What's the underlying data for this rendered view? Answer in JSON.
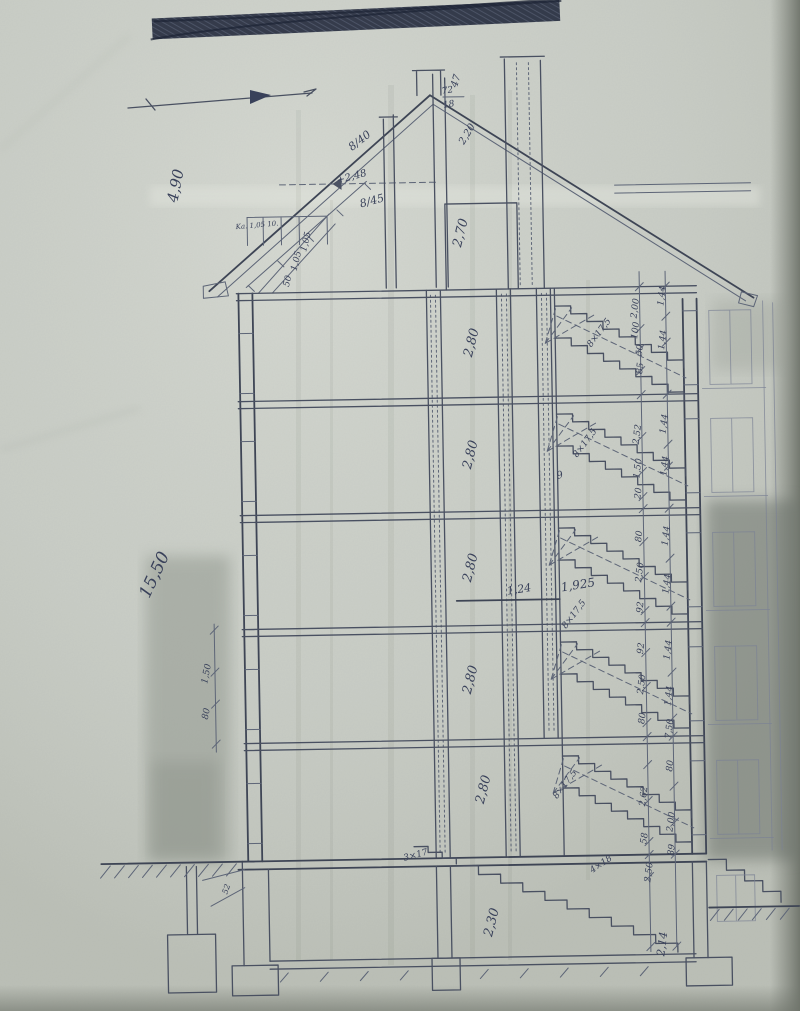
{
  "document": {
    "type": "scanned hand-drawn architectural cross-section (old blueprint photocopy)",
    "redaction_note": "hand-scribbled blacked-out line at top of sheet"
  },
  "annotations": [
    {
      "t": "4,90",
      "x": 186,
      "y": 182,
      "r": -78,
      "s": 15,
      "n": "roof-height-label"
    },
    {
      "t": "47",
      "x": 466,
      "y": 82,
      "r": -72,
      "s": 10,
      "n": "dimension-label"
    },
    {
      "t": "72",
      "x": 455,
      "y": 93,
      "r": -8,
      "s": 9,
      "n": "chimney-size-numerator"
    },
    {
      "t": "18",
      "x": 456,
      "y": 107,
      "r": -8,
      "s": 9,
      "n": "chimney-size-denominator"
    },
    {
      "t": "2,20",
      "x": 476,
      "y": 136,
      "r": -58,
      "s": 10,
      "n": "dimension-label"
    },
    {
      "t": "8/40",
      "x": 368,
      "y": 142,
      "r": -37,
      "s": 11,
      "n": "rafter-size-label"
    },
    {
      "t": "+2,48",
      "x": 358,
      "y": 178,
      "r": -14,
      "s": 10,
      "n": "level-label"
    },
    {
      "t": "8/45",
      "x": 378,
      "y": 203,
      "r": -14,
      "s": 11,
      "n": "rafter-size-label"
    },
    {
      "t": "Ka. 1,05 10.",
      "x": 262,
      "y": 224,
      "r": -4,
      "s": 7,
      "n": "attic-note-label"
    },
    {
      "t": "50",
      "x": 294,
      "y": 279,
      "r": -75,
      "s": 9,
      "n": "dimension-label"
    },
    {
      "t": "1,05",
      "x": 303,
      "y": 259,
      "r": -75,
      "s": 9,
      "n": "dimension-label"
    },
    {
      "t": "1,05",
      "x": 313,
      "y": 240,
      "r": -75,
      "s": 9,
      "n": "dimension-label"
    },
    {
      "t": "2,70",
      "x": 469,
      "y": 234,
      "r": -75,
      "s": 13,
      "n": "room-height-label"
    },
    {
      "t": "2,80",
      "x": 478,
      "y": 344,
      "r": -75,
      "s": 13,
      "n": "room-height-label"
    },
    {
      "t": "2,80",
      "x": 475,
      "y": 456,
      "r": -75,
      "s": 13,
      "n": "room-height-label"
    },
    {
      "t": "2,80",
      "x": 473,
      "y": 569,
      "r": -75,
      "s": 13,
      "n": "room-height-label"
    },
    {
      "t": "2,80",
      "x": 471,
      "y": 681,
      "r": -75,
      "s": 13,
      "n": "room-height-label"
    },
    {
      "t": "2,80",
      "x": 482,
      "y": 791,
      "r": -75,
      "s": 13,
      "n": "room-height-label"
    },
    {
      "t": "2,30",
      "x": 488,
      "y": 924,
      "r": -75,
      "s": 13,
      "n": "room-height-label"
    },
    {
      "t": "15,50",
      "x": 158,
      "y": 572,
      "r": -64,
      "s": 17,
      "n": "overall-height-label"
    },
    {
      "t": "1,50",
      "x": 206,
      "y": 670,
      "r": -78,
      "s": 9,
      "n": "dimension-label"
    },
    {
      "t": "80",
      "x": 205,
      "y": 710,
      "r": -78,
      "s": 9,
      "n": "dimension-label"
    },
    {
      "t": "1,24",
      "x": 518,
      "y": 594,
      "r": -8,
      "s": 11,
      "n": "landing-width-label"
    },
    {
      "t": "1,925",
      "x": 577,
      "y": 591,
      "r": -8,
      "s": 12,
      "n": "landing-width-label"
    },
    {
      "t": "8×17,5",
      "x": 604,
      "y": 337,
      "r": -52,
      "s": 9,
      "n": "stair-formula-label"
    },
    {
      "t": "8×17,5",
      "x": 588,
      "y": 447,
      "r": -52,
      "s": 9,
      "n": "stair-formula-label"
    },
    {
      "t": "8×17,5",
      "x": 574,
      "y": 618,
      "r": -52,
      "s": 9,
      "n": "stair-formula-label"
    },
    {
      "t": "8×17,5",
      "x": 562,
      "y": 788,
      "r": -52,
      "s": 9,
      "n": "stair-formula-label"
    },
    {
      "t": "3×17",
      "x": 410,
      "y": 857,
      "r": -14,
      "s": 9,
      "n": "stair-formula-label"
    },
    {
      "t": "4×18",
      "x": 596,
      "y": 869,
      "r": -33,
      "s": 9,
      "n": "stair-formula-label"
    },
    {
      "t": "9",
      "x": 561,
      "y": 480,
      "r": -15,
      "s": 10,
      "n": "stair-count-label"
    },
    {
      "t": "52",
      "x": 222,
      "y": 886,
      "r": -70,
      "s": 8,
      "n": "dimension-label"
    },
    {
      "t": "2,00",
      "x": 641,
      "y": 312,
      "r": -82,
      "s": 9,
      "n": "dimension-label"
    },
    {
      "t": "100",
      "x": 641,
      "y": 334,
      "r": -82,
      "s": 9,
      "n": "dimension-label"
    },
    {
      "t": "50",
      "x": 645,
      "y": 354,
      "r": -82,
      "s": 9,
      "n": "dimension-label"
    },
    {
      "t": "85",
      "x": 645,
      "y": 372,
      "r": -82,
      "s": 9,
      "n": "dimension-label"
    },
    {
      "t": "2,52",
      "x": 641,
      "y": 438,
      "r": -82,
      "s": 9,
      "n": "dimension-label"
    },
    {
      "t": "1,50",
      "x": 641,
      "y": 472,
      "r": -82,
      "s": 9,
      "n": "dimension-label"
    },
    {
      "t": "20",
      "x": 641,
      "y": 497,
      "r": -82,
      "s": 9,
      "n": "dimension-label"
    },
    {
      "t": "80",
      "x": 641,
      "y": 540,
      "r": -82,
      "s": 9,
      "n": "dimension-label"
    },
    {
      "t": "2,50",
      "x": 641,
      "y": 576,
      "r": -82,
      "s": 9,
      "n": "dimension-label"
    },
    {
      "t": "92",
      "x": 641,
      "y": 611,
      "r": -82,
      "s": 9,
      "n": "dimension-label"
    },
    {
      "t": "92",
      "x": 641,
      "y": 652,
      "r": -82,
      "s": 9,
      "n": "dimension-label"
    },
    {
      "t": "2,50",
      "x": 641,
      "y": 688,
      "r": -82,
      "s": 9,
      "n": "dimension-label"
    },
    {
      "t": "80",
      "x": 641,
      "y": 722,
      "r": -82,
      "s": 9,
      "n": "dimension-label"
    },
    {
      "t": "2,62",
      "x": 641,
      "y": 800,
      "r": -82,
      "s": 9,
      "n": "dimension-label"
    },
    {
      "t": "58",
      "x": 641,
      "y": 842,
      "r": -82,
      "s": 9,
      "n": "dimension-label"
    },
    {
      "t": "2,50",
      "x": 645,
      "y": 876,
      "r": -82,
      "s": 9,
      "n": "dimension-label"
    },
    {
      "t": "1,44",
      "x": 668,
      "y": 300,
      "r": -82,
      "s": 9,
      "n": "dimension-label"
    },
    {
      "t": "1,44",
      "x": 668,
      "y": 344,
      "r": -82,
      "s": 9,
      "n": "dimension-label"
    },
    {
      "t": "1,44",
      "x": 668,
      "y": 428,
      "r": -82,
      "s": 9,
      "n": "dimension-label"
    },
    {
      "t": "1,44",
      "x": 668,
      "y": 470,
      "r": -82,
      "s": 9,
      "n": "dimension-label"
    },
    {
      "t": "1,44",
      "x": 668,
      "y": 540,
      "r": -82,
      "s": 9,
      "n": "dimension-label"
    },
    {
      "t": "1,44",
      "x": 668,
      "y": 588,
      "r": -82,
      "s": 9,
      "n": "dimension-label"
    },
    {
      "t": "1,44",
      "x": 668,
      "y": 654,
      "r": -82,
      "s": 9,
      "n": "dimension-label"
    },
    {
      "t": "1,44",
      "x": 668,
      "y": 700,
      "r": -82,
      "s": 9,
      "n": "dimension-label"
    },
    {
      "t": "7,50",
      "x": 668,
      "y": 733,
      "r": -82,
      "s": 9,
      "n": "dimension-label"
    },
    {
      "t": "80",
      "x": 668,
      "y": 770,
      "r": -82,
      "s": 9,
      "n": "dimension-label"
    },
    {
      "t": "2,00",
      "x": 668,
      "y": 826,
      "r": -82,
      "s": 9,
      "n": "dimension-label"
    },
    {
      "t": "89",
      "x": 668,
      "y": 854,
      "r": -82,
      "s": 9,
      "n": "dimension-label"
    },
    {
      "t": "2,14",
      "x": 658,
      "y": 948,
      "r": -82,
      "s": 11,
      "n": "basement-depth-label"
    }
  ]
}
